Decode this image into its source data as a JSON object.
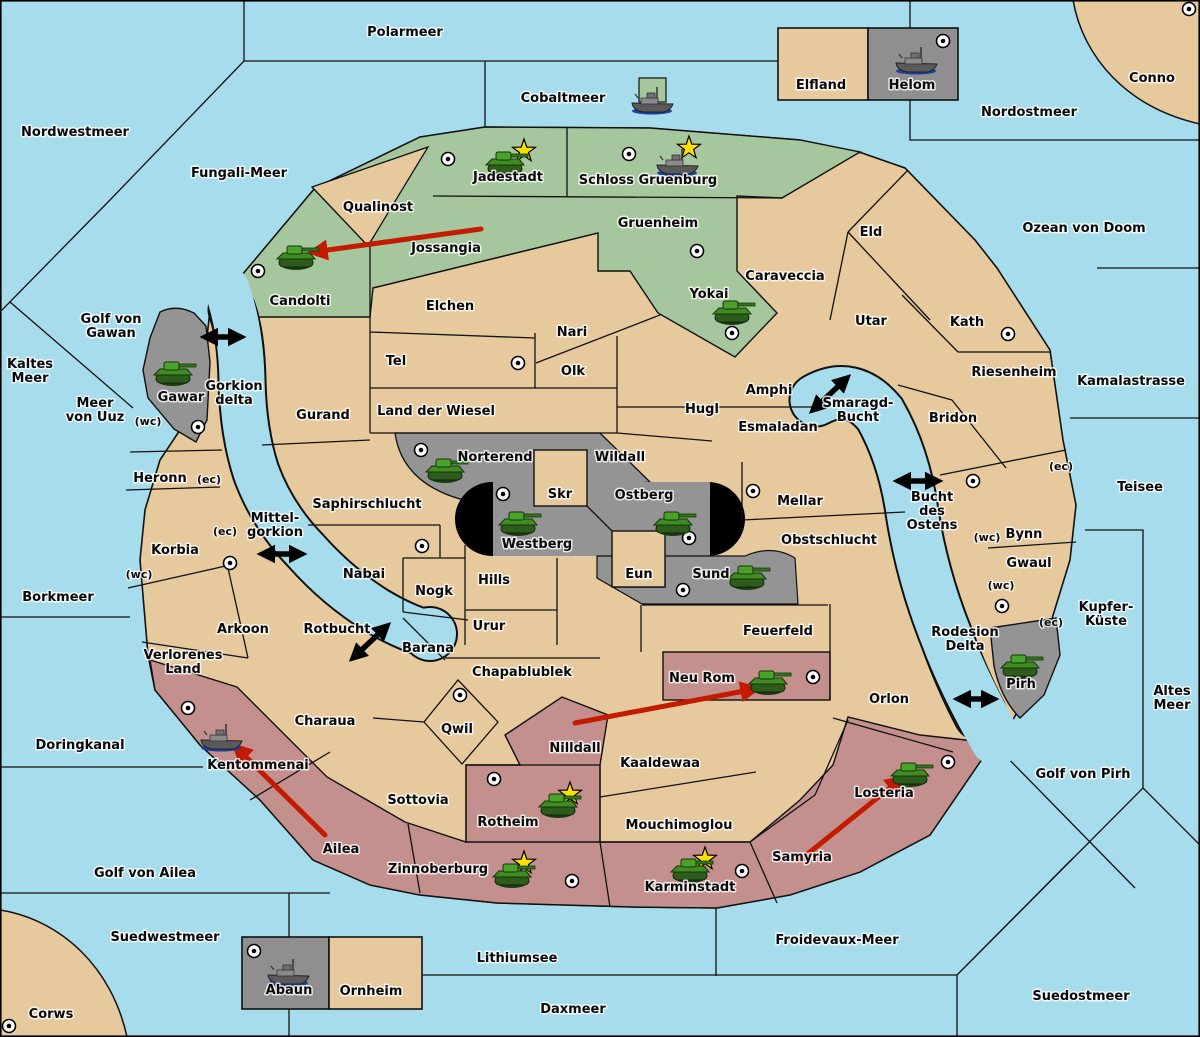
{
  "map_title": "Diplomacy-style strategy map",
  "colors": {
    "sea": "#a7dcec",
    "land": "#e7c99e",
    "green_power": "#a6c69d",
    "gray_power": "#949494",
    "red_power": "#c3908d",
    "black_zone": "#000000",
    "move_arrow": "#c41a00",
    "strait_arrow": "#000000",
    "star": "#ffdf00"
  },
  "seas": [
    {
      "name": "Polarmeer",
      "pos": [
        405,
        32
      ]
    },
    {
      "name": "Cobaltmeer",
      "pos": [
        563,
        98
      ]
    },
    {
      "name": "Nordostmeer",
      "pos": [
        1029,
        112
      ]
    },
    {
      "name": "Conno",
      "pos": [
        1152,
        78
      ]
    },
    {
      "name": "Nordwestmeer",
      "pos": [
        75,
        132
      ]
    },
    {
      "name": "Fungali-Meer",
      "pos": [
        239,
        173
      ]
    },
    {
      "name": "Ozean von Doom",
      "pos": [
        1084,
        228
      ]
    },
    {
      "name": "Golf von Gawan",
      "lines": [
        "Golf von",
        "Gawan"
      ],
      "pos": [
        111,
        326
      ]
    },
    {
      "name": "Kaltes Meer",
      "lines": [
        "Kaltes",
        "Meer"
      ],
      "pos": [
        30,
        371
      ]
    },
    {
      "name": "Meer von Uuz",
      "lines": [
        "Meer",
        "von Uuz"
      ],
      "pos": [
        95,
        410
      ]
    },
    {
      "name": "Gorkion delta",
      "lines": [
        "Gorkion",
        "delta"
      ],
      "pos": [
        234,
        393
      ]
    },
    {
      "name": "Kamalastrasse",
      "pos": [
        1131,
        381
      ]
    },
    {
      "name": "Smaragd-Bucht",
      "lines": [
        "Smaragd-",
        "Bucht"
      ],
      "pos": [
        858,
        410
      ]
    },
    {
      "name": "Bucht des Ostens",
      "lines": [
        "Bucht",
        "des",
        "Ostens"
      ],
      "pos": [
        932,
        511
      ]
    },
    {
      "name": "Teisee",
      "pos": [
        1140,
        487
      ]
    },
    {
      "name": "Mittel-gorkion",
      "lines": [
        "Mittel-",
        "gorkion"
      ],
      "pos": [
        275,
        525
      ]
    },
    {
      "name": "Borkmeer",
      "pos": [
        58,
        597
      ]
    },
    {
      "name": "Rotbucht",
      "pos": [
        337,
        629
      ]
    },
    {
      "name": "Kupfer-Küste",
      "lines": [
        "Kupfer-",
        "Küste"
      ],
      "pos": [
        1106,
        614
      ]
    },
    {
      "name": "Rodesion Delta",
      "lines": [
        "Rodesion",
        "Delta"
      ],
      "pos": [
        965,
        639
      ]
    },
    {
      "name": "Altes Meer",
      "lines": [
        "Altes",
        "Meer"
      ],
      "pos": [
        1172,
        698
      ]
    },
    {
      "name": "Golf von Pirh",
      "pos": [
        1083,
        774
      ]
    },
    {
      "name": "Doringkanal",
      "pos": [
        80,
        745
      ]
    },
    {
      "name": "Golf von Ailea",
      "pos": [
        145,
        873
      ]
    },
    {
      "name": "Suedwestmeer",
      "pos": [
        165,
        937
      ]
    },
    {
      "name": "Lithiumsee",
      "pos": [
        517,
        958
      ]
    },
    {
      "name": "Froidevaux-Meer",
      "pos": [
        837,
        940
      ]
    },
    {
      "name": "Daxmeer",
      "pos": [
        573,
        1009
      ]
    },
    {
      "name": "Suedostmeer",
      "pos": [
        1081,
        996
      ]
    },
    {
      "name": "Corws",
      "pos": [
        51,
        1014
      ]
    }
  ],
  "territories": [
    {
      "name": "Jadestadt",
      "region": "green",
      "pos": [
        508,
        177
      ]
    },
    {
      "name": "Schloss Gruenburg",
      "region": "green",
      "pos": [
        648,
        180
      ]
    },
    {
      "name": "Qualinost",
      "region": "land",
      "pos": [
        378,
        207
      ]
    },
    {
      "name": "Jossangia",
      "region": "green",
      "pos": [
        446,
        248
      ]
    },
    {
      "name": "Candolti",
      "region": "green",
      "pos": [
        300,
        301
      ]
    },
    {
      "name": "Gruenheim",
      "region": "green",
      "pos": [
        658,
        223
      ]
    },
    {
      "name": "Yokai",
      "region": "green",
      "pos": [
        709,
        294
      ]
    },
    {
      "name": "Elfland",
      "region": "land",
      "pos": [
        821,
        85
      ]
    },
    {
      "name": "Helom",
      "region": "gray",
      "pos": [
        912,
        85
      ]
    },
    {
      "name": "Eld",
      "region": "land",
      "pos": [
        871,
        232
      ]
    },
    {
      "name": "Caraveccia",
      "region": "land",
      "pos": [
        785,
        276
      ]
    },
    {
      "name": "Elchen",
      "region": "land",
      "pos": [
        450,
        306
      ]
    },
    {
      "name": "Nari",
      "region": "land",
      "pos": [
        572,
        332
      ]
    },
    {
      "name": "Tel",
      "region": "land",
      "pos": [
        396,
        361
      ]
    },
    {
      "name": "Olk",
      "region": "land",
      "pos": [
        573,
        371
      ]
    },
    {
      "name": "Utar",
      "region": "land",
      "pos": [
        871,
        321
      ]
    },
    {
      "name": "Kath",
      "region": "land",
      "pos": [
        967,
        322
      ]
    },
    {
      "name": "Riesenheim",
      "region": "land",
      "pos": [
        1014,
        372
      ]
    },
    {
      "name": "Gurand",
      "region": "land",
      "pos": [
        323,
        415
      ]
    },
    {
      "name": "Land der Wiesel",
      "region": "land",
      "pos": [
        436,
        411
      ]
    },
    {
      "name": "Hugl",
      "region": "land",
      "pos": [
        702,
        409
      ]
    },
    {
      "name": "Amphi",
      "region": "land",
      "pos": [
        769,
        390
      ]
    },
    {
      "name": "Esmaladan",
      "region": "land",
      "pos": [
        778,
        427
      ]
    },
    {
      "name": "Bridon",
      "region": "land",
      "pos": [
        953,
        418
      ]
    },
    {
      "name": "Gawar",
      "region": "gray",
      "pos": [
        181,
        397
      ]
    },
    {
      "name": "Norterend",
      "region": "gray",
      "pos": [
        495,
        457
      ]
    },
    {
      "name": "Wildall",
      "region": "land",
      "pos": [
        620,
        457
      ]
    },
    {
      "name": "Skr",
      "region": "land",
      "pos": [
        560,
        494
      ]
    },
    {
      "name": "Ostberg",
      "region": "gray",
      "pos": [
        644,
        495
      ]
    },
    {
      "name": "Westberg",
      "region": "gray",
      "pos": [
        537,
        544
      ]
    },
    {
      "name": "Mellar",
      "region": "land",
      "pos": [
        800,
        501
      ]
    },
    {
      "name": "Heronn",
      "region": "land",
      "pos": [
        160,
        478
      ]
    },
    {
      "name": "Saphirschlucht",
      "region": "land",
      "pos": [
        367,
        504
      ]
    },
    {
      "name": "Korbia",
      "region": "land",
      "pos": [
        175,
        550
      ]
    },
    {
      "name": "Obstschlucht",
      "region": "land",
      "pos": [
        829,
        540
      ]
    },
    {
      "name": "Bynn",
      "region": "land",
      "pos": [
        1024,
        534
      ]
    },
    {
      "name": "Gwaul",
      "region": "land",
      "pos": [
        1029,
        563
      ]
    },
    {
      "name": "Nabai",
      "region": "land",
      "pos": [
        364,
        574
      ]
    },
    {
      "name": "Hills",
      "region": "land",
      "pos": [
        494,
        580
      ]
    },
    {
      "name": "Nogk",
      "region": "land",
      "pos": [
        434,
        591
      ]
    },
    {
      "name": "Eun",
      "region": "land",
      "pos": [
        639,
        574
      ]
    },
    {
      "name": "Sund",
      "region": "gray",
      "pos": [
        711,
        574
      ]
    },
    {
      "name": "Urur",
      "region": "land",
      "pos": [
        489,
        626
      ]
    },
    {
      "name": "Feuerfeld",
      "region": "land",
      "pos": [
        778,
        631
      ]
    },
    {
      "name": "Arkoon",
      "region": "land",
      "pos": [
        243,
        629
      ]
    },
    {
      "name": "Barana",
      "region": "land",
      "pos": [
        428,
        648
      ]
    },
    {
      "name": "Chapablublek",
      "region": "land",
      "pos": [
        522,
        672
      ]
    },
    {
      "name": "Neu Rom",
      "region": "red",
      "pos": [
        702,
        678
      ]
    },
    {
      "name": "Orlon",
      "region": "land",
      "pos": [
        889,
        699
      ]
    },
    {
      "name": "Pirh",
      "region": "gray",
      "pos": [
        1021,
        684
      ]
    },
    {
      "name": "Verlorenes Land",
      "region": "land",
      "lines": [
        "Verlorenes",
        "Land"
      ],
      "pos": [
        183,
        662
      ]
    },
    {
      "name": "Charaua",
      "region": "land",
      "pos": [
        325,
        721
      ]
    },
    {
      "name": "Qwil",
      "region": "land",
      "pos": [
        457,
        729
      ]
    },
    {
      "name": "Nilldall",
      "region": "red",
      "pos": [
        575,
        748
      ]
    },
    {
      "name": "Kaaldewaa",
      "region": "land",
      "pos": [
        660,
        763
      ]
    },
    {
      "name": "Kentommenai",
      "region": "red",
      "pos": [
        258,
        765
      ]
    },
    {
      "name": "Losteria",
      "region": "red",
      "pos": [
        884,
        793
      ]
    },
    {
      "name": "Rotheim",
      "region": "red",
      "pos": [
        508,
        822
      ]
    },
    {
      "name": "Mouchimoglou",
      "region": "land",
      "pos": [
        679,
        825
      ]
    },
    {
      "name": "Sottovia",
      "region": "land",
      "pos": [
        418,
        800
      ]
    },
    {
      "name": "Ailea",
      "region": "red",
      "pos": [
        341,
        849
      ]
    },
    {
      "name": "Samyria",
      "region": "red",
      "pos": [
        802,
        857
      ]
    },
    {
      "name": "Zinnoberburg",
      "region": "red",
      "pos": [
        438,
        869
      ]
    },
    {
      "name": "Karminstadt",
      "region": "red",
      "pos": [
        690,
        887
      ]
    },
    {
      "name": "Abaun",
      "region": "gray",
      "pos": [
        289,
        990
      ]
    },
    {
      "name": "Ornheim",
      "region": "land",
      "pos": [
        371,
        991
      ]
    }
  ],
  "coast_labels": [
    {
      "text": "(wc)",
      "pos": [
        148,
        421
      ]
    },
    {
      "text": "(ec)",
      "pos": [
        209,
        479
      ]
    },
    {
      "text": "(ec)",
      "pos": [
        225,
        531
      ]
    },
    {
      "text": "(wc)",
      "pos": [
        139,
        574
      ]
    },
    {
      "text": "(ec)",
      "pos": [
        1061,
        466
      ]
    },
    {
      "text": "(wc)",
      "pos": [
        987,
        537
      ]
    },
    {
      "text": "(wc)",
      "pos": [
        1001,
        585
      ]
    },
    {
      "text": "(ec)",
      "pos": [
        1051,
        622
      ]
    }
  ],
  "supply_centers": [
    {
      "territory": "Jadestadt",
      "pos": [
        448,
        159
      ]
    },
    {
      "territory": "Schloss Gruenburg",
      "pos": [
        629,
        154
      ]
    },
    {
      "territory": "Candolti",
      "pos": [
        258,
        271
      ]
    },
    {
      "territory": "Helom",
      "pos": [
        943,
        41
      ]
    },
    {
      "territory": "Conno",
      "pos": [
        1189,
        9
      ]
    },
    {
      "territory": "Gruenheim",
      "pos": [
        697,
        251
      ]
    },
    {
      "territory": "Yokai",
      "pos": [
        732,
        333
      ]
    },
    {
      "territory": "Tel",
      "pos": [
        518,
        363
      ]
    },
    {
      "territory": "Kath",
      "pos": [
        1008,
        334
      ]
    },
    {
      "territory": "Gawar",
      "pos": [
        198,
        427
      ]
    },
    {
      "territory": "Bridon",
      "pos": [
        973,
        481
      ]
    },
    {
      "territory": "Norterend",
      "pos": [
        421,
        450
      ]
    },
    {
      "territory": "Westberg",
      "pos": [
        503,
        494
      ]
    },
    {
      "territory": "Ostberg",
      "pos": [
        689,
        538
      ]
    },
    {
      "territory": "Mellar",
      "pos": [
        753,
        491
      ]
    },
    {
      "territory": "Hills",
      "pos": [
        422,
        546
      ]
    },
    {
      "territory": "Korbia",
      "pos": [
        230,
        563
      ]
    },
    {
      "territory": "Sund",
      "pos": [
        683,
        590
      ]
    },
    {
      "territory": "Pirh",
      "pos": [
        1002,
        606
      ]
    },
    {
      "territory": "Losteria",
      "pos": [
        948,
        762
      ]
    },
    {
      "territory": "Neu Rom",
      "pos": [
        813,
        677
      ]
    },
    {
      "territory": "Kentommenai",
      "pos": [
        188,
        708
      ]
    },
    {
      "territory": "Rotheim",
      "pos": [
        494,
        779
      ]
    },
    {
      "territory": "Qwil",
      "pos": [
        460,
        695
      ]
    },
    {
      "territory": "Zinnoberburg",
      "pos": [
        572,
        881
      ]
    },
    {
      "territory": "Karminstadt",
      "pos": [
        742,
        871
      ]
    },
    {
      "territory": "Abaun",
      "pos": [
        254,
        951
      ]
    },
    {
      "territory": "Corws",
      "pos": [
        9,
        1026
      ]
    }
  ],
  "stars": [
    {
      "territory": "Jadestadt",
      "pos": [
        524,
        151
      ]
    },
    {
      "territory": "Schloss Gruenburg",
      "pos": [
        689,
        148
      ]
    },
    {
      "territory": "Rotheim",
      "pos": [
        570,
        794
      ]
    },
    {
      "territory": "Zinnoberburg",
      "pos": [
        524,
        863
      ]
    },
    {
      "territory": "Karminstadt",
      "pos": [
        705,
        859
      ]
    }
  ],
  "units": [
    {
      "type": "tank",
      "territory": "Candolti",
      "pos": [
        296,
        257
      ]
    },
    {
      "type": "tank",
      "territory": "Jadestadt",
      "pos": [
        505,
        163
      ]
    },
    {
      "type": "tank",
      "territory": "Yokai",
      "pos": [
        732,
        312
      ]
    },
    {
      "type": "tank",
      "territory": "Gawar",
      "pos": [
        173,
        373
      ]
    },
    {
      "type": "tank",
      "territory": "Norterend",
      "pos": [
        445,
        470
      ]
    },
    {
      "type": "tank",
      "territory": "Westberg",
      "pos": [
        518,
        523
      ]
    },
    {
      "type": "tank",
      "territory": "Ostberg",
      "pos": [
        673,
        523
      ]
    },
    {
      "type": "tank",
      "territory": "Sund",
      "pos": [
        747,
        577
      ]
    },
    {
      "type": "tank",
      "territory": "Neu Rom",
      "pos": [
        768,
        682
      ]
    },
    {
      "type": "tank",
      "territory": "Pirh",
      "pos": [
        1020,
        666
      ]
    },
    {
      "type": "tank",
      "territory": "Losteria",
      "pos": [
        910,
        774
      ]
    },
    {
      "type": "tank",
      "territory": "Rotheim",
      "pos": [
        558,
        805
      ]
    },
    {
      "type": "tank",
      "territory": "Zinnoberburg",
      "pos": [
        512,
        875
      ]
    },
    {
      "type": "tank",
      "territory": "Karminstadt",
      "pos": [
        690,
        870
      ]
    },
    {
      "type": "ship",
      "territory": "Cobaltmeer",
      "pos": [
        652,
        100
      ],
      "patch": "green_power"
    },
    {
      "type": "ship",
      "territory": "Helom",
      "pos": [
        916,
        60
      ]
    },
    {
      "type": "ship",
      "territory": "Schloss Gruenburg",
      "pos": [
        677,
        162
      ]
    },
    {
      "type": "ship",
      "territory": "Kentommenai",
      "pos": [
        221,
        737
      ]
    },
    {
      "type": "ship",
      "territory": "Abaun",
      "pos": [
        288,
        972
      ]
    }
  ],
  "move_arrows": [
    {
      "from": "Jossangia",
      "to": "Candolti",
      "line": [
        481,
        229,
        313,
        252
      ]
    },
    {
      "from": "Nilldall",
      "to": "Neu Rom",
      "line": [
        575,
        723,
        755,
        689
      ]
    },
    {
      "from": "Ailea",
      "to": "Kentommenai",
      "line": [
        325,
        835,
        236,
        747
      ]
    },
    {
      "from": "Samyria",
      "to": "Losteria",
      "line": [
        800,
        860,
        901,
        779
      ]
    }
  ],
  "strait_arrows": [
    {
      "at": "Golf von Gawan / Gorkion delta",
      "line": [
        205,
        337,
        241,
        337
      ]
    },
    {
      "at": "Smaragd-Bucht",
      "line": [
        813,
        410,
        847,
        378
      ]
    },
    {
      "at": "Bucht des Ostens",
      "line": [
        898,
        481,
        938,
        481
      ]
    },
    {
      "at": "Mittel-gorkion",
      "line": [
        262,
        554,
        302,
        554
      ]
    },
    {
      "at": "Rotbucht",
      "line": [
        353,
        658,
        387,
        626
      ]
    },
    {
      "at": "Rodesion Delta / Pirh",
      "line": [
        958,
        699,
        994,
        699
      ]
    }
  ]
}
